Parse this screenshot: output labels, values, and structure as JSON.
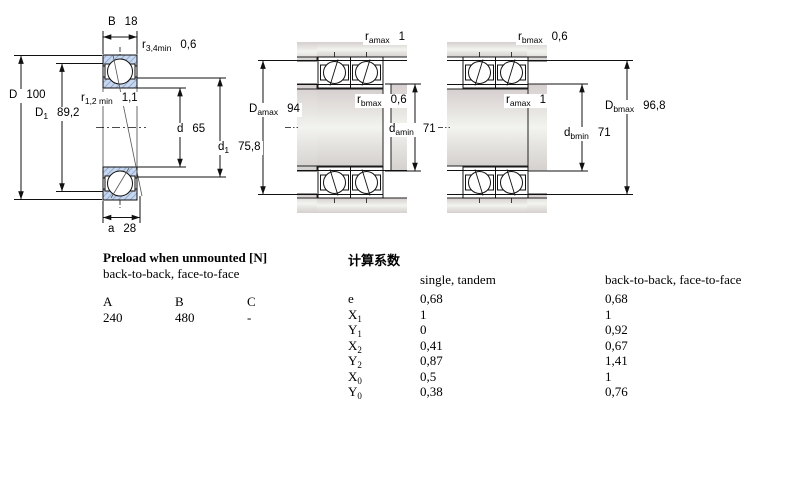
{
  "colors": {
    "ring_hatch_blue": "#c9d8ee",
    "ring_hatch_line": "#91abce",
    "metal_gray": "#d6d0ce",
    "line": "#111111"
  },
  "dims": {
    "left": {
      "B": {
        "main": "B",
        "sub": "",
        "value": "18"
      },
      "r34": {
        "main": "r",
        "sub": "3,4min",
        "value": "0,6"
      },
      "D": {
        "main": "D",
        "sub": "",
        "value": "100"
      },
      "D1": {
        "main": "D",
        "sub": "1",
        "value": "89,2"
      },
      "r12": {
        "main": "r",
        "sub": "1,2 min",
        "value": "1,1"
      },
      "d": {
        "main": "d",
        "sub": "",
        "value": "65"
      },
      "d1": {
        "main": "d",
        "sub": "1",
        "value": "75,8"
      },
      "a": {
        "main": "a",
        "sub": "",
        "value": "28"
      }
    },
    "middle": {
      "ramax": {
        "main": "r",
        "sub": "amax",
        "value": "1"
      },
      "rbmax": {
        "main": "r",
        "sub": "bmax",
        "value": "0,6"
      },
      "Damax": {
        "main": "D",
        "sub": "amax",
        "value": "94"
      },
      "damin": {
        "main": "d",
        "sub": "amin",
        "value": "71"
      }
    },
    "right": {
      "rbmax": {
        "main": "r",
        "sub": "bmax",
        "value": "0,6"
      },
      "ramax": {
        "main": "r",
        "sub": "amax",
        "value": "1"
      },
      "Dbmax": {
        "main": "D",
        "sub": "bmax",
        "value": "96,8"
      },
      "dbmin": {
        "main": "d",
        "sub": "bmin",
        "value": "71"
      }
    }
  },
  "preload": {
    "title": "Preload when unmounted [N]",
    "subtitle": "back-to-back, face-to-face",
    "headers": [
      "A",
      "B",
      "C"
    ],
    "values": [
      "240",
      "480",
      "-"
    ]
  },
  "factors": {
    "title": "计算系数",
    "col_single": "single, tandem",
    "col_b2b": "back-to-back, face-to-face",
    "rows": [
      {
        "label": "e",
        "sub": "",
        "single": "0,68",
        "b2b": "0,68"
      },
      {
        "label": "X",
        "sub": "1",
        "single": "1",
        "b2b": "1"
      },
      {
        "label": "Y",
        "sub": "1",
        "single": "0",
        "b2b": "0,92"
      },
      {
        "label": "X",
        "sub": "2",
        "single": "0,41",
        "b2b": "0,67"
      },
      {
        "label": "Y",
        "sub": "2",
        "single": "0,87",
        "b2b": "1,41"
      },
      {
        "label": "X",
        "sub": "0",
        "single": "0,5",
        "b2b": "1"
      },
      {
        "label": "Y",
        "sub": "0",
        "single": "0,38",
        "b2b": "0,76"
      }
    ]
  }
}
